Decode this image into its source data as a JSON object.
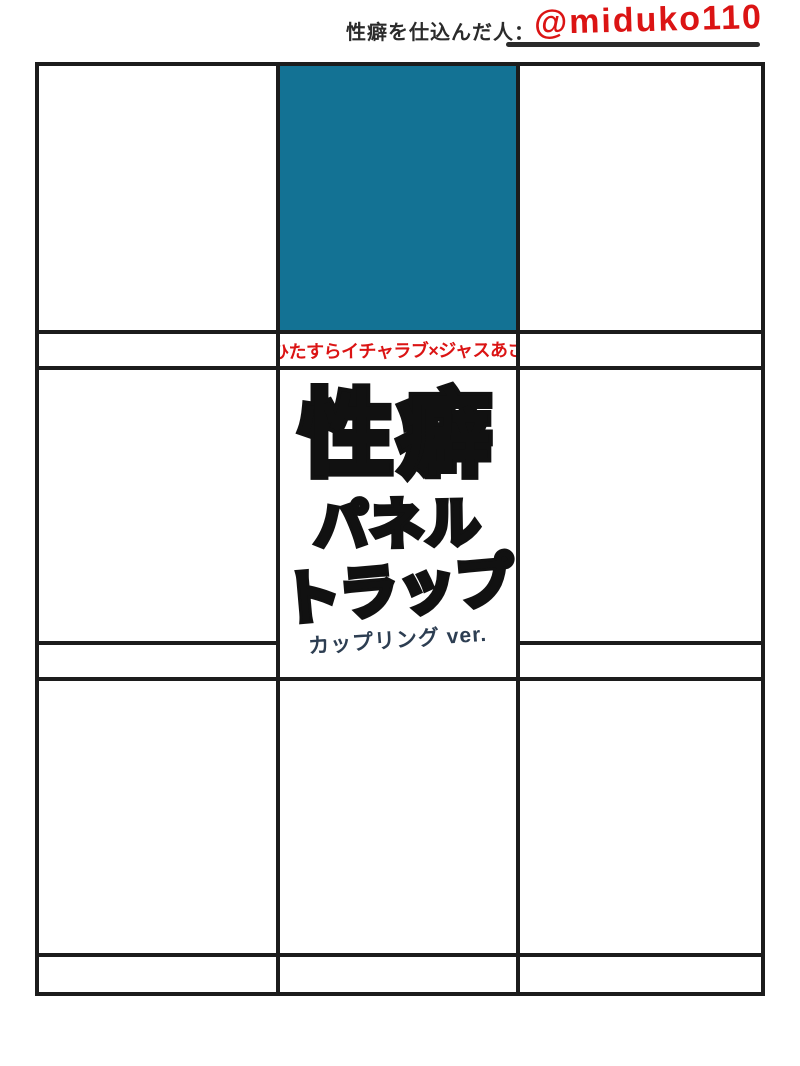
{
  "header": {
    "label": "性癖を仕込んだ人：",
    "handle": "@miduko110"
  },
  "panels": {
    "caption_row1_middle": "ひたすらイチャラブ×ジャスあざ"
  },
  "title": {
    "line1": "性癖",
    "line2": "パネル",
    "line3": "トラップ",
    "subtitle": "カップリング ver."
  },
  "colors": {
    "teal_panel": "#137294",
    "accent_red": "#db1414",
    "grid_line": "#1c1c1c",
    "subtitle_ink": "#2d3e52",
    "header_text": "#2b2b2b"
  }
}
